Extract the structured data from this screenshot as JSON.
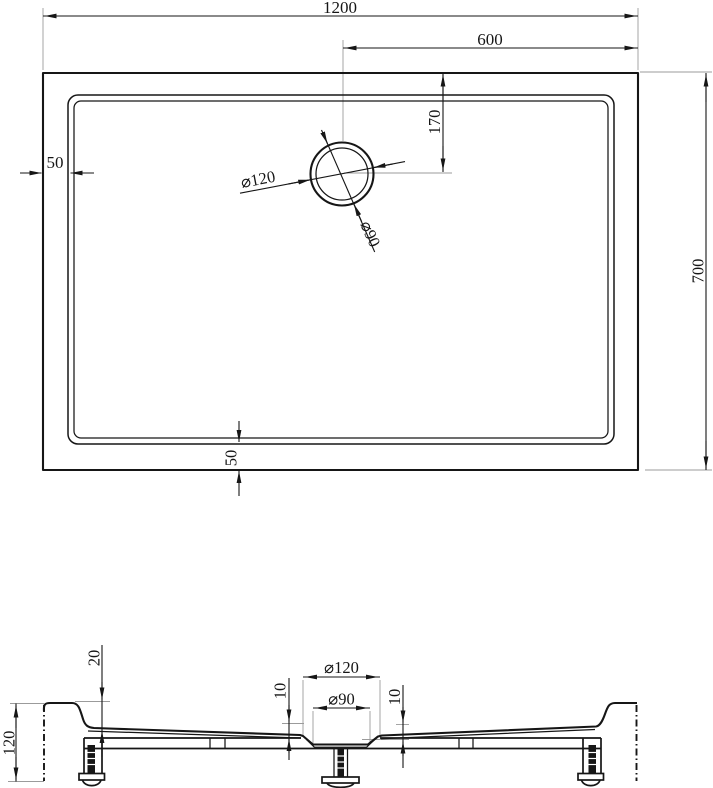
{
  "top_view": {
    "width": "1200",
    "drain_offset_from_right": "600",
    "drain_offset_from_top": "170",
    "height": "700",
    "rim_left": "50",
    "rim_bottom": "50",
    "drain_outer_dia": "⌀120",
    "drain_inner_dia": "⌀90"
  },
  "section_view": {
    "rim_drop": "20",
    "total_height": "120",
    "recess_outer_dia": "⌀120",
    "recess_inner_dia": "⌀90",
    "step_left": "10",
    "step_right": "10"
  },
  "colors": {
    "line": "#161616",
    "extension_line": "#9b9b9b",
    "background": "#ffffff"
  }
}
